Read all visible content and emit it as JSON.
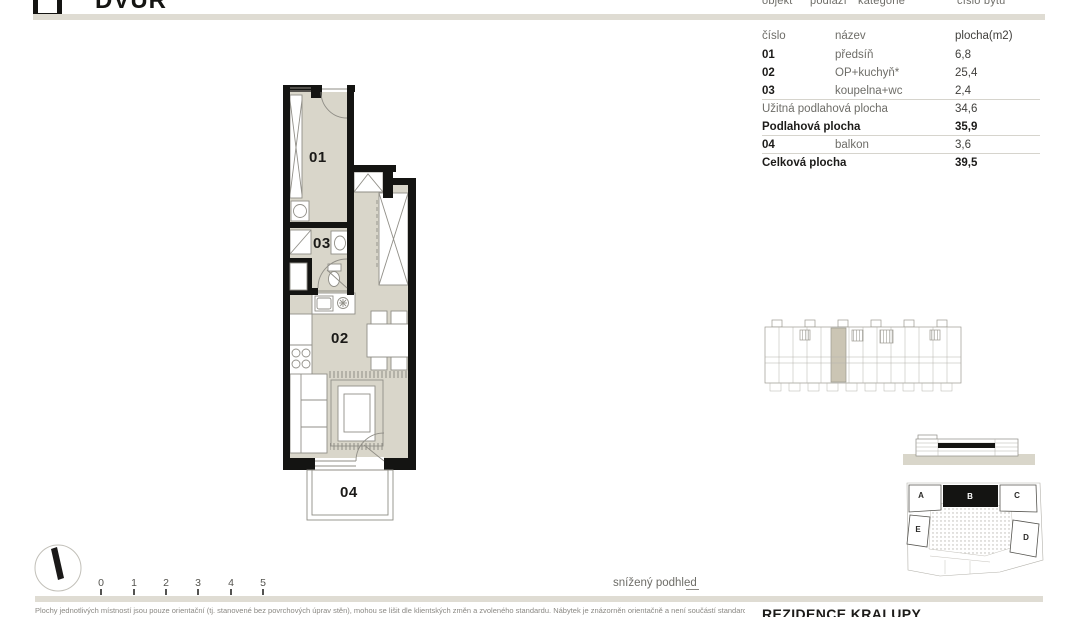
{
  "logo": {
    "text": "DVŮR"
  },
  "meta": {
    "labels": [
      "objekt",
      "podlaží",
      "kategorie",
      "číslo bytu"
    ]
  },
  "room_table": {
    "header": {
      "num": "číslo",
      "name": "název",
      "area": "plocha(m2)"
    },
    "rows": [
      {
        "num": "01",
        "name": "předsíň",
        "area": "6,8"
      },
      {
        "num": "02",
        "name": "OP+kuchyň*",
        "area": "25,4"
      },
      {
        "num": "03",
        "name": "koupelna+wc",
        "area": "2,4"
      },
      {
        "num": "",
        "name": "Užitná podlahová plocha",
        "area": "34,6"
      },
      {
        "num": "",
        "name": "Podlahová plocha",
        "area": "35,9"
      },
      {
        "num": "04",
        "name": "balkon",
        "area": "3,6"
      },
      {
        "num": "",
        "name": "Celková plocha",
        "area": "39,5"
      }
    ]
  },
  "floor_plan": {
    "labels": [
      {
        "text": "01"
      },
      {
        "text": "02"
      },
      {
        "text": "03"
      },
      {
        "text": "04"
      }
    ]
  },
  "legend": {
    "lowered_ceiling": "snížený podhled"
  },
  "scale_bar": {
    "ticks": [
      "0",
      "1",
      "2",
      "3",
      "4",
      "5"
    ]
  },
  "site_plan": {
    "buildings": [
      {
        "label": "A"
      },
      {
        "label": "B"
      },
      {
        "label": "C"
      },
      {
        "label": "D"
      },
      {
        "label": "E"
      }
    ],
    "highlighted": "B"
  },
  "footer": {
    "project": "REZIDENCE KRALUPY",
    "disclaimer": "Plochy jednotlivých místností jsou pouze orientační (tj. stanovené bez povrchových úprav stěn), mohou se lišit dle klientských změn a zvoleného standardu. Nábytek je znázorněn orientačně a není součástí standardu."
  },
  "colors": {
    "floor": "#d9d6ca",
    "wall": "#141412",
    "bar": "#dfdcd3",
    "highlight_unit": "#cbc5b4"
  }
}
